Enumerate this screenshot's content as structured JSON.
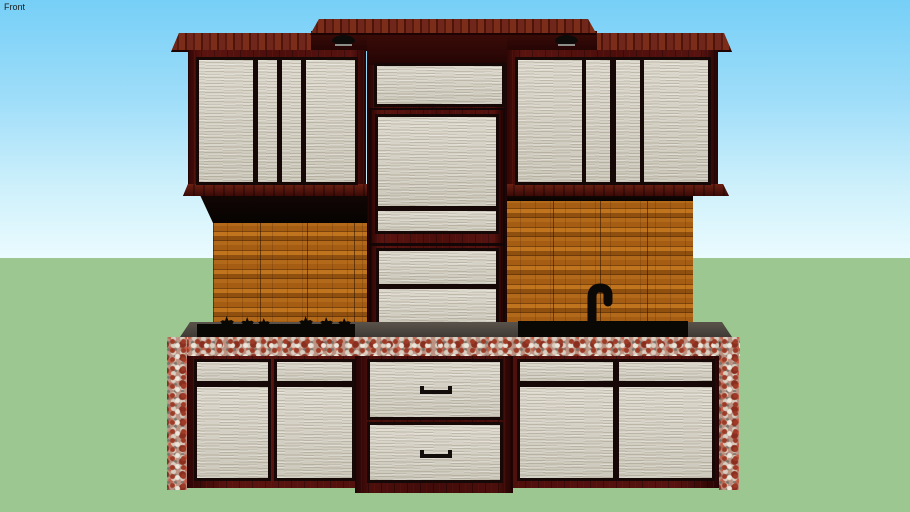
{
  "viewport": {
    "view_label": "Front"
  },
  "scene": {
    "description": "3D front (orthographic) view of a kitchen cabinet model on a sky and grass backdrop",
    "parts": [
      "center valance board",
      "upper cabinet left with four doors",
      "upper cabinet right with four doors",
      "tall center cabinet with stacked panels",
      "under-cabinet puck lights",
      "wood plank backsplash left",
      "wood plank backsplash right",
      "cooktop with burner grate silhouettes",
      "sink basin with gooseneck faucet",
      "granite countertop edge and side returns",
      "lower cabinet left with two doors",
      "center drawer unit with two pull handles",
      "lower cabinet right with two doors"
    ]
  },
  "colors": {
    "sky_top": "#76cff7",
    "sky_horizon": "#eafbfe",
    "ground": "#9cc791",
    "cabinet_frame": "#4c0e0b",
    "crown_molding": "#6f2516",
    "door_panel": "#d6d2c5",
    "backsplash_wood": "#9e5a14",
    "granite": "#bc9282",
    "counter_surface": "#46403a",
    "fixture_black": "#0a0805"
  }
}
